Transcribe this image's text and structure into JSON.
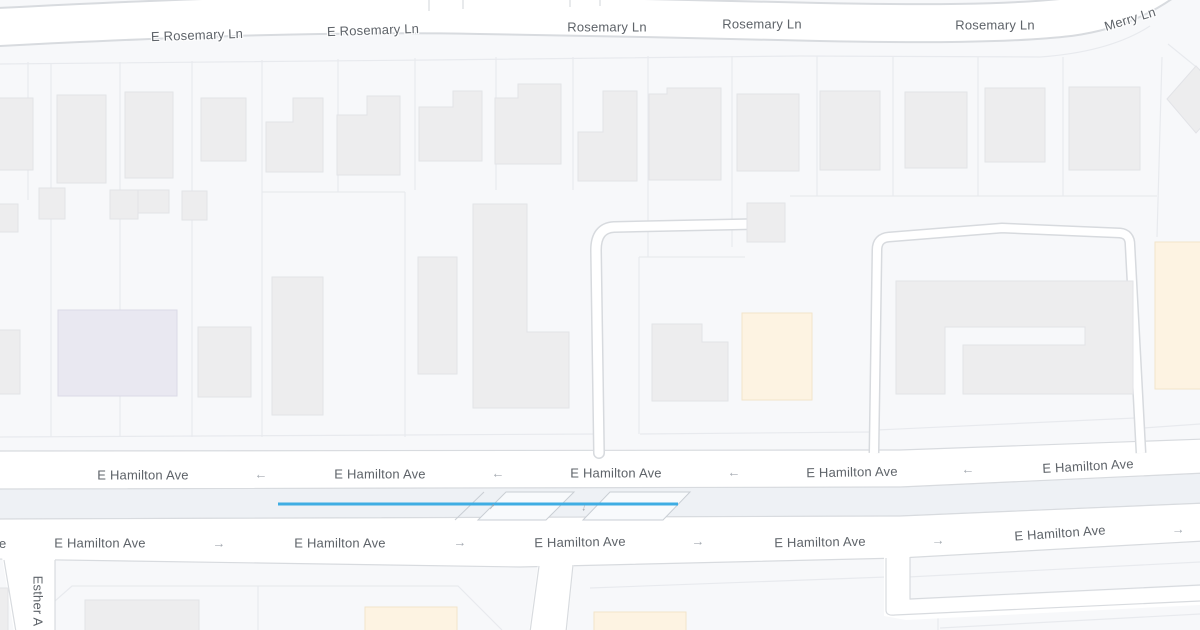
{
  "map_meta": {
    "type": "street-map",
    "background_color": "#f7f8fa",
    "road_color": "#ffffff",
    "road_casing_color": "#d8dbdf",
    "route_highlight_color": "#3fade3",
    "building_color": "#ededee",
    "highlighted_building_color": "#fdf3e2",
    "civic_building_color": "#e9e8f1",
    "label_color": "#5e6369"
  },
  "streets": {
    "rosemary": [
      "E Rosemary Ln",
      "E Rosemary Ln",
      "Rosemary Ln",
      "Rosemary Ln",
      "Rosemary Ln"
    ],
    "merry": "Merry Ln",
    "hamilton_westbound": [
      "E Hamilton Ave",
      "E Hamilton Ave",
      "E Hamilton Ave",
      "E Hamilton Ave",
      "E Hamilton Ave"
    ],
    "hamilton_eastbound": [
      "E Hamilton Ave",
      "E Hamilton Ave",
      "E Hamilton Ave",
      "E Hamilton Ave",
      "E Hamilton Ave"
    ],
    "esther": "Esther A",
    "clipped_label_fragment": "e"
  },
  "icons": {
    "one_way_left": "←",
    "one_way_right": "→",
    "lane_arrow_up": "↑",
    "lane_arrow_down": "↓"
  }
}
